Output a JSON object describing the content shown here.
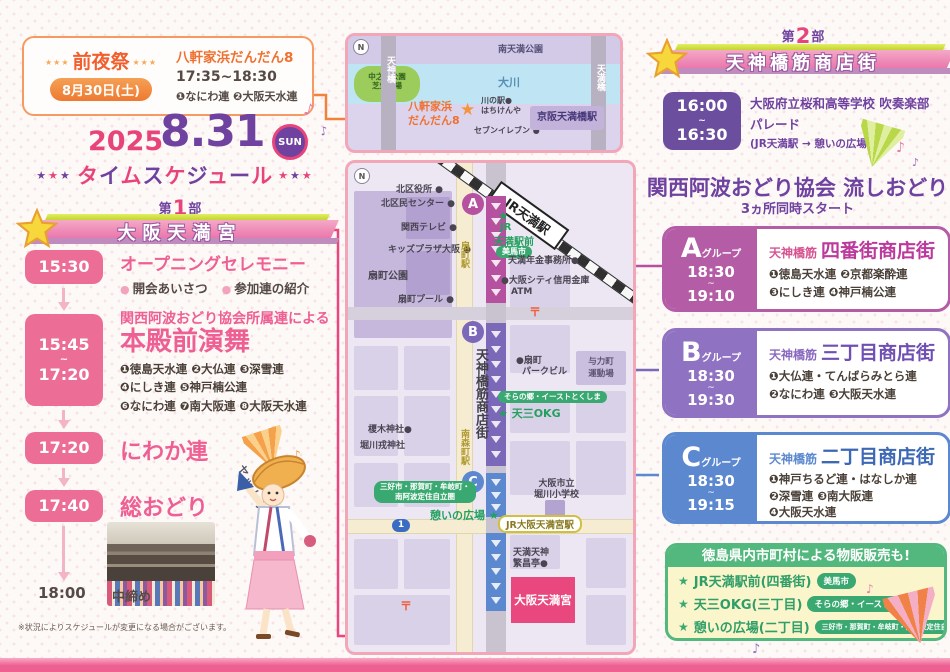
{
  "colors": {
    "pink": "#e8447c",
    "purple": "#6f42a0",
    "orange": "#f0823c",
    "magenta": "#b5519f",
    "violet": "#7b68b8",
    "blue": "#5b88cf",
    "green": "#53b87e"
  },
  "eve": {
    "stars_left": "★★★",
    "title": "前夜祭",
    "stars_right": "★★★",
    "date": "8月30日(土)",
    "venue": "八軒家浜だんだん8",
    "time": "17:35~18:30",
    "groups": "❶なにわ連 ❷大阪天水連"
  },
  "title": {
    "year": "2025",
    "date": "8.31",
    "day": "SUN",
    "stars_left": "★★★",
    "name": "タイムスケジュール",
    "stars_right": "★★★"
  },
  "part1": {
    "pre": "第",
    "num": "1",
    "post": "部",
    "banner": "大阪天満宮"
  },
  "part2": {
    "pre": "第",
    "num": "2",
    "post": "部",
    "banner": "天神橋筋商店街"
  },
  "timeline": {
    "t1": {
      "time": "15:30",
      "title": "オープニングセレモニー",
      "b1": "開会あいさつ",
      "b2": "参加連の紹介"
    },
    "t2": {
      "start": "15:45",
      "tilde": "~",
      "end": "17:20",
      "lead": "関西阿波おどり協会所属連による",
      "title": "本殿前演舞",
      "m1": "❶徳島天水連 ❷大仏連 ❸深雪連",
      "m2": "❹にしき連 ❺神戸楠公連",
      "m3": "❻なにわ連 ❼南大阪連 ❽大阪天水連"
    },
    "t3": {
      "time": "17:20",
      "title": "にわか連"
    },
    "t4": {
      "time": "17:40",
      "title": "総おどり"
    },
    "t5": {
      "time": "18:00",
      "title": "中締め"
    },
    "note": "※状況によりスケジュールが変更になる場合がございます。"
  },
  "mascot": {
    "speech": "ヤットサー!"
  },
  "parade": {
    "start": "16:00",
    "tilde": "~",
    "end": "16:30",
    "line1": "大阪府立桜和高等学校 吹奏楽部",
    "line2": "パレード",
    "line3": "(JR天満駅 → 憩いの広場)"
  },
  "nagashi": {
    "title": "関西阿波おどり協会 流しおどり",
    "subtitle": "3ヵ所同時スタート",
    "groups": [
      {
        "letter": "A",
        "suffix": "グループ",
        "start": "18:30",
        "tilde": "~",
        "end": "19:10",
        "area_pre": "天神橋筋",
        "area": "四番街商店街",
        "m1": "❶徳島天水連 ❷京都楽酔連",
        "m2": "❸にしき連 ❹神戸楠公連",
        "m3": ""
      },
      {
        "letter": "B",
        "suffix": "グループ",
        "start": "18:30",
        "tilde": "~",
        "end": "19:30",
        "area_pre": "天神橋筋",
        "area": "三丁目商店街",
        "m1": "❶大仏連・てんばらみとら連",
        "m2": "❷なにわ連 ❸大阪天水連",
        "m3": ""
      },
      {
        "letter": "C",
        "suffix": "グループ",
        "start": "18:30",
        "tilde": "~",
        "end": "19:15",
        "area_pre": "天神橋筋",
        "area": "二丁目商店街",
        "m1": "❶神戸ちるど連・はなしか連",
        "m2": "❷深雪連 ❸南大阪連",
        "m3": "❹大阪天水連"
      }
    ]
  },
  "goods": {
    "title": "徳島県内市町村による物販販売も!",
    "items": [
      {
        "star": "★",
        "place": "JR天満駅前(四番街)",
        "badge": "美馬市"
      },
      {
        "star": "★",
        "place": "天三OKG(三丁目)",
        "badge": "そらの郷・イーストとくしま"
      },
      {
        "star": "★",
        "place": "憩いの広場(二丁目)",
        "badge": "三好市・那賀町・牟岐町・南阿波定住自立圏"
      }
    ]
  },
  "small_map": {
    "compass": "N",
    "park_top": "南天満公園",
    "river": "大川",
    "green1": "中之島公園",
    "green2": "芝生広場",
    "road_left": "天神橋",
    "road_right": "天満橋",
    "venue1": "八軒家浜",
    "venue2": "だんだん8",
    "star": "★",
    "kawa1": "川の駅●",
    "kawa2": "はちけんや",
    "seven": "セブンイレブン ●",
    "keihan": "京阪天満橋駅"
  },
  "map": {
    "compass": "N",
    "kuyakusho": "北区役所 ●",
    "kumin_center": "北区民センター ●",
    "kansai_tv": "関西テレビ ●",
    "kids_plaza": "キッズプラザ大阪 ●",
    "ogimachi_park": "扇町公園",
    "ogimachi_pool": "扇町プール ●",
    "ogimachi_sta": "扇町駅",
    "jr_temma": "JR天満駅",
    "temma_star": "★",
    "temma1": "JR",
    "temma2": "天満駅前",
    "mima": "美馬市",
    "nenkin": "天満年金事務所●",
    "shinkin": "●大阪シティ信用金庫",
    "atm": "ATM",
    "post": "〒",
    "park_bldg1": "●扇町",
    "park_bldg2": "パークビル",
    "yoriki1": "与力町",
    "yoriki2": "運動場",
    "shotengai": "天神橋筋商店街",
    "sora": "そらの郷・イーストとくしま",
    "tensan": "★ 天三OKG",
    "minamimori_sta": "南森町駅",
    "enoki": "榎木神社●",
    "ebisu": "堀川戎神社",
    "miyoshi1": "三好市・那賀町・牟岐町・",
    "miyoshi2": "南阿波定住自立圏",
    "ikoi": "憩いの広場 ★",
    "route1": "1",
    "jr_ot": "JR大阪天満宮駅",
    "school1": "大阪市立",
    "school2": "堀川小学校",
    "hanjo1": "天満天神",
    "hanjo2": "繁昌亭●",
    "tenmangu": "大阪天満宮",
    "a": "A",
    "b": "B",
    "c": "C"
  }
}
